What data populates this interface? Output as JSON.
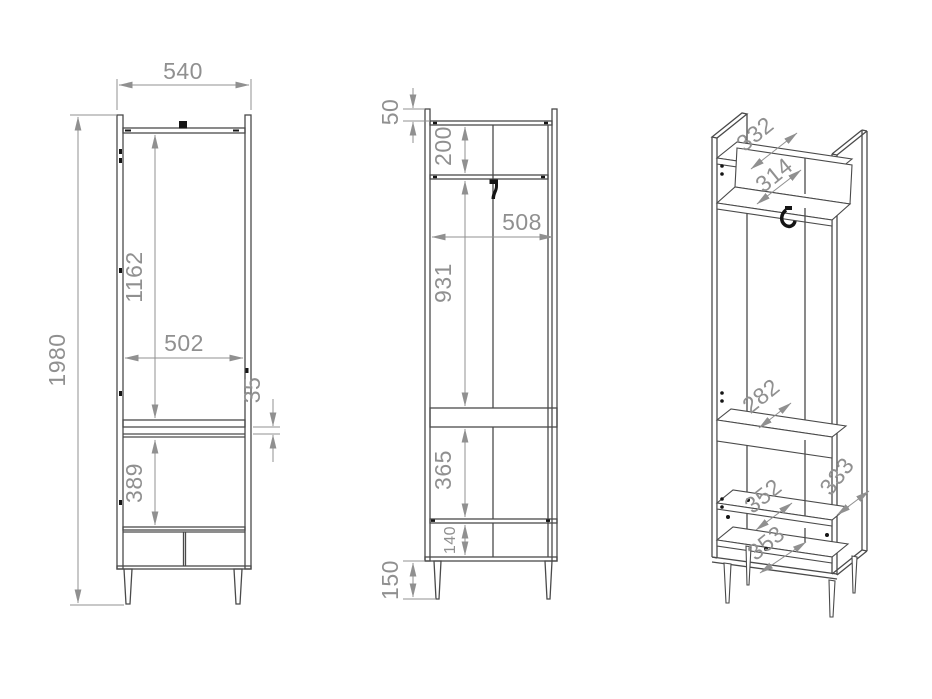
{
  "colors": {
    "furniture_line": "#4a4a4a",
    "dimension": "#909090",
    "hardware": "#151515",
    "background": "#ffffff"
  },
  "views": {
    "front": {
      "dims": {
        "overall_width": "540",
        "overall_height": "1980",
        "upper_compartment_height": "1162",
        "inner_width": "502",
        "rail_gap": "35",
        "lower_compartment_height": "389"
      }
    },
    "side": {
      "dims": {
        "top_overhang": "50",
        "top_shelf_height": "200",
        "inner_depth": "508",
        "hanging_height": "931",
        "lower_height": "365",
        "drawer_height": "140",
        "leg_height": "150"
      }
    },
    "iso": {
      "dims": {
        "top_panel_depth": "332",
        "shelf_depth": "314",
        "rail_depth": "282",
        "lower_shelf_depth": "352",
        "side_panel_depth": "333",
        "bottom_panel_depth": "353"
      }
    }
  }
}
